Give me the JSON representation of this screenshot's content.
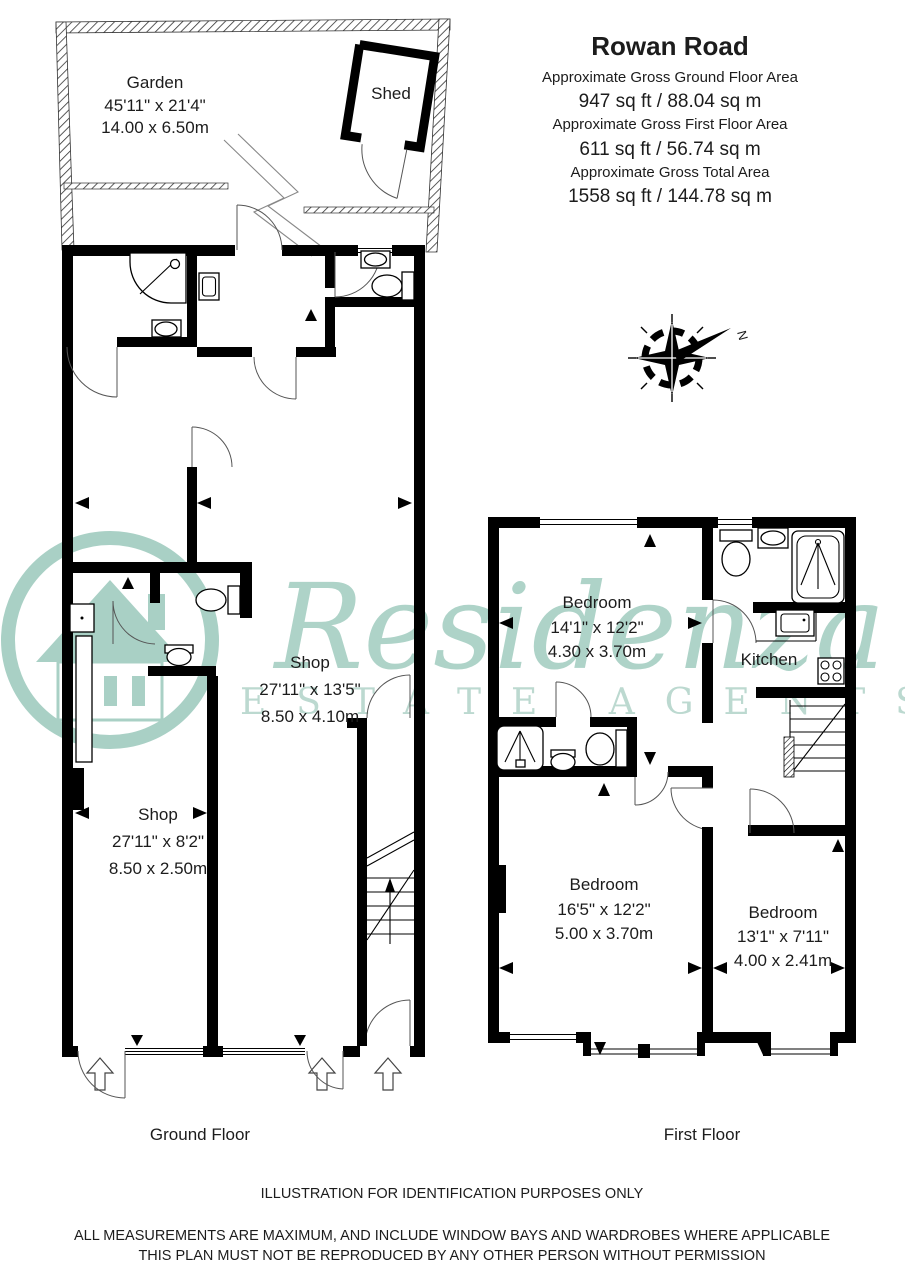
{
  "header": {
    "title": "Rowan Road",
    "areas": [
      {
        "label": "Approximate Gross Ground Floor Area",
        "value": "947 sq ft  /  88.04 sq m"
      },
      {
        "label": "Approximate Gross First Floor Area",
        "value": "611 sq ft  /  56.74 sq m"
      },
      {
        "label": "Approximate Gross Total Area",
        "value": "1558 sq ft  / 144.78 sq m"
      }
    ]
  },
  "compass": {
    "north_label": "N"
  },
  "watermark": {
    "name": "Residenza",
    "tagline": "ESTATE AGENTS",
    "color": "#aed3c8"
  },
  "ground_floor": {
    "caption": "Ground Floor",
    "garden": {
      "name": "Garden",
      "dims_imperial": "45'11\" x 21'4\"",
      "dims_metric": "14.00 x 6.50m"
    },
    "shed": {
      "name": "Shed"
    },
    "shop_rear": {
      "name": "Shop",
      "dims_imperial": "27'11\" x 13'5\"",
      "dims_metric": "8.50 x 4.10m"
    },
    "shop_front": {
      "name": "Shop",
      "dims_imperial": "27'11\" x 8'2\"",
      "dims_metric": "8.50 x 2.50m"
    }
  },
  "first_floor": {
    "caption": "First Floor",
    "bedroom_front": {
      "name": "Bedroom",
      "dims_imperial": "14'1\" x 12'2\"",
      "dims_metric": "4.30 x 3.70m"
    },
    "kitchen": {
      "name": "Kitchen"
    },
    "bedroom_middle": {
      "name": "Bedroom",
      "dims_imperial": "16'5\" x 12'2\"",
      "dims_metric": "5.00 x 3.70m"
    },
    "bedroom_rear": {
      "name": "Bedroom",
      "dims_imperial": "13'1\" x 7'11\"",
      "dims_metric": "4.00 x 2.41m"
    }
  },
  "footer": {
    "line1": "ILLUSTRATION FOR IDENTIFICATION PURPOSES ONLY",
    "line2": "ALL MEASUREMENTS ARE MAXIMUM, AND INCLUDE WINDOW BAYS AND WARDROBES WHERE APPLICABLE",
    "line3": "THIS PLAN MUST NOT BE REPRODUCED BY ANY OTHER PERSON WITHOUT PERMISSION"
  }
}
